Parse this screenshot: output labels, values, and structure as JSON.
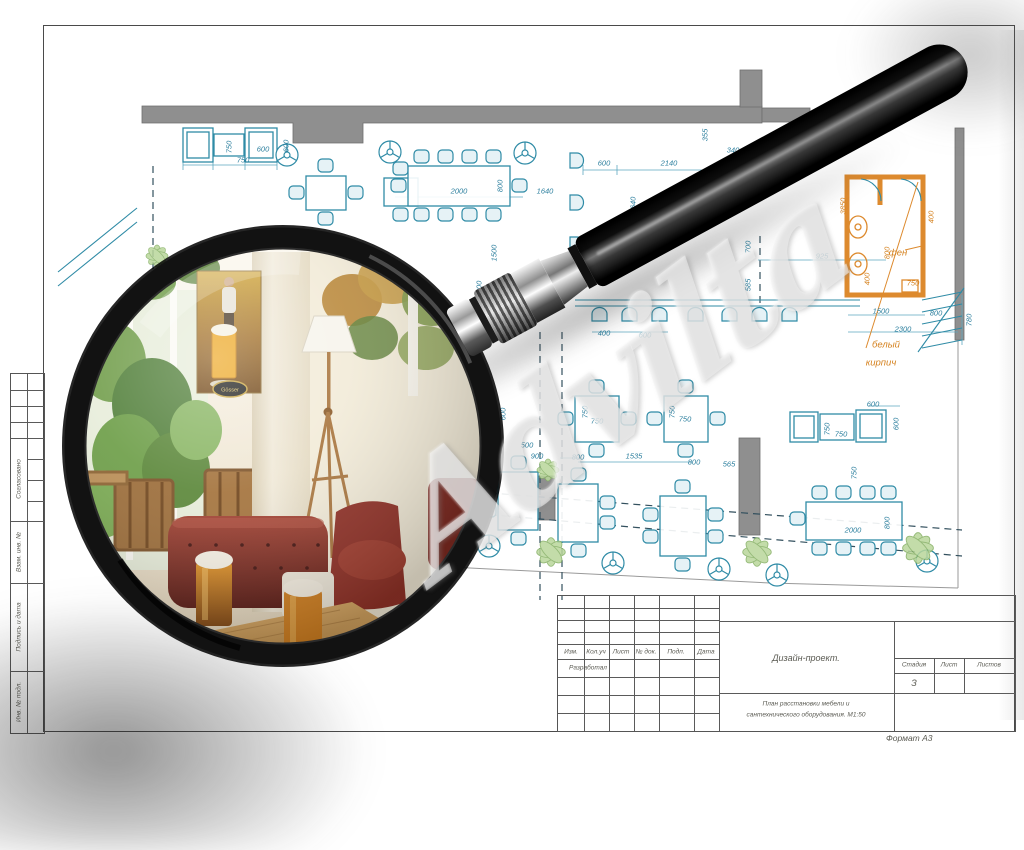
{
  "watermark": "Advilta",
  "side_stamp": {
    "approved": "Согласовано",
    "replace_inv": "Взам. инв. №",
    "sign_date": "Подпись и дата",
    "inv_no": "Инв. № подл."
  },
  "title_block": {
    "rev_headers": [
      "Изм.",
      "Кол.уч",
      "Лист",
      "№ док.",
      "Подп.",
      "Дата"
    ],
    "developed": "Разработал",
    "project": "Дизайн-проект.",
    "sheet_title_1": "План расстановки мебели и",
    "sheet_title_2": "сантехнического оборудования. М1:50",
    "stage_label": "Стадия",
    "sheet_label": "Лист",
    "sheets_label": "Листов",
    "stage_value": "З",
    "format": "Формат А3"
  },
  "lens": {
    "badge": "Gösser"
  },
  "plan": {
    "dims": [
      {
        "t": "750",
        "x": 229,
        "y": 147,
        "v": 1
      },
      {
        "t": "750",
        "x": 243,
        "y": 160
      },
      {
        "t": "600",
        "x": 263,
        "y": 149
      },
      {
        "t": "600",
        "x": 286,
        "y": 146,
        "v": 1
      },
      {
        "t": "2000",
        "x": 459,
        "y": 191
      },
      {
        "t": "800",
        "x": 500,
        "y": 186,
        "v": 1
      },
      {
        "t": "1640",
        "x": 545,
        "y": 191
      },
      {
        "t": "1500",
        "x": 494,
        "y": 253,
        "v": 1
      },
      {
        "t": "600",
        "x": 604,
        "y": 163
      },
      {
        "t": "2140",
        "x": 669,
        "y": 163
      },
      {
        "t": "1640",
        "x": 633,
        "y": 205,
        "v": 1
      },
      {
        "t": "340",
        "x": 733,
        "y": 150
      },
      {
        "t": "355",
        "x": 705,
        "y": 135,
        "v": 1
      },
      {
        "t": "400",
        "x": 604,
        "y": 333
      },
      {
        "t": "600",
        "x": 645,
        "y": 335
      },
      {
        "t": "700",
        "x": 748,
        "y": 247,
        "v": 1
      },
      {
        "t": "585",
        "x": 748,
        "y": 285,
        "v": 1
      },
      {
        "t": "925",
        "x": 822,
        "y": 256
      },
      {
        "t": "3850",
        "x": 843,
        "y": 206,
        "v": 1,
        "o": 1
      },
      {
        "t": "600",
        "x": 479,
        "y": 287,
        "v": 1
      },
      {
        "t": "600",
        "x": 481,
        "y": 384
      },
      {
        "t": "600",
        "x": 503,
        "y": 414,
        "v": 1
      },
      {
        "t": "800",
        "x": 493,
        "y": 445
      },
      {
        "t": "500",
        "x": 527,
        "y": 445
      },
      {
        "t": "900",
        "x": 537,
        "y": 456
      },
      {
        "t": "750",
        "x": 585,
        "y": 412,
        "v": 1
      },
      {
        "t": "750",
        "x": 597,
        "y": 421
      },
      {
        "t": "750",
        "x": 672,
        "y": 412,
        "v": 1
      },
      {
        "t": "750",
        "x": 685,
        "y": 419
      },
      {
        "t": "800",
        "x": 578,
        "y": 457
      },
      {
        "t": "1535",
        "x": 634,
        "y": 456
      },
      {
        "t": "800",
        "x": 694,
        "y": 462
      },
      {
        "t": "565",
        "x": 729,
        "y": 464
      },
      {
        "t": "600",
        "x": 873,
        "y": 404
      },
      {
        "t": "750",
        "x": 827,
        "y": 429,
        "v": 1
      },
      {
        "t": "750",
        "x": 841,
        "y": 434
      },
      {
        "t": "600",
        "x": 896,
        "y": 424,
        "v": 1
      },
      {
        "t": "750",
        "x": 854,
        "y": 473,
        "v": 1
      },
      {
        "t": "2000",
        "x": 853,
        "y": 530
      },
      {
        "t": "800",
        "x": 887,
        "y": 523,
        "v": 1
      },
      {
        "t": "400",
        "x": 931,
        "y": 217,
        "v": 1,
        "o": 1
      },
      {
        "t": "800",
        "x": 887,
        "y": 253,
        "v": 1,
        "o": 1
      },
      {
        "t": "400",
        "x": 867,
        "y": 279,
        "v": 1,
        "o": 1
      },
      {
        "t": "750",
        "x": 913,
        "y": 283,
        "o": 1
      },
      {
        "t": "1500",
        "x": 881,
        "y": 311
      },
      {
        "t": "800",
        "x": 936,
        "y": 313
      },
      {
        "t": "2300",
        "x": 903,
        "y": 329
      },
      {
        "t": "780",
        "x": 969,
        "y": 320,
        "v": 1
      },
      {
        "t": "фен",
        "x": 898,
        "y": 253,
        "o": 1,
        "L": 1
      },
      {
        "t": "белый",
        "x": 886,
        "y": 345,
        "o": 1,
        "L": 1
      },
      {
        "t": "кирпич",
        "x": 881,
        "y": 363,
        "o": 1,
        "L": 1
      }
    ]
  }
}
